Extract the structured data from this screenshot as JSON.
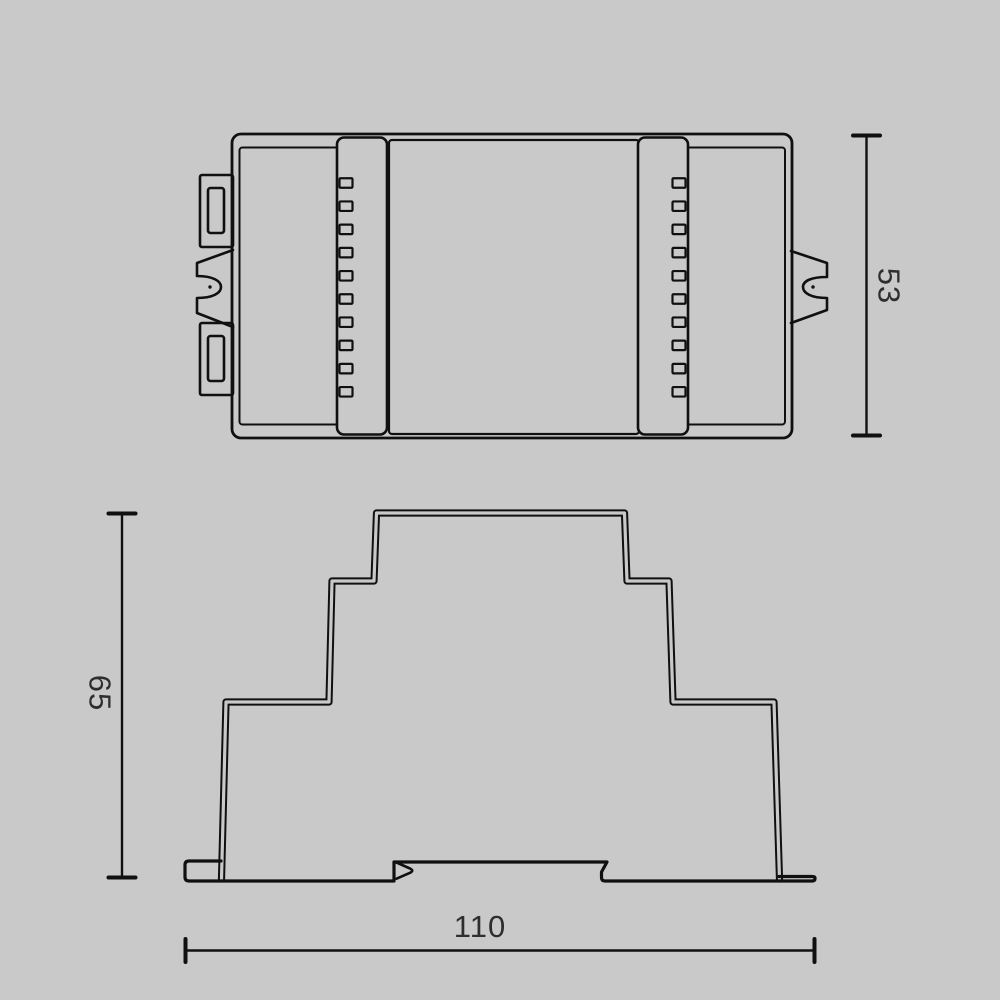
{
  "drawing": {
    "background_color": "#c9c9c9",
    "line_color": "#101010",
    "text_color": "#2e2e2e",
    "dimensions": {
      "top_view_height": "53",
      "side_view_height": "65",
      "side_view_width": "110"
    }
  }
}
